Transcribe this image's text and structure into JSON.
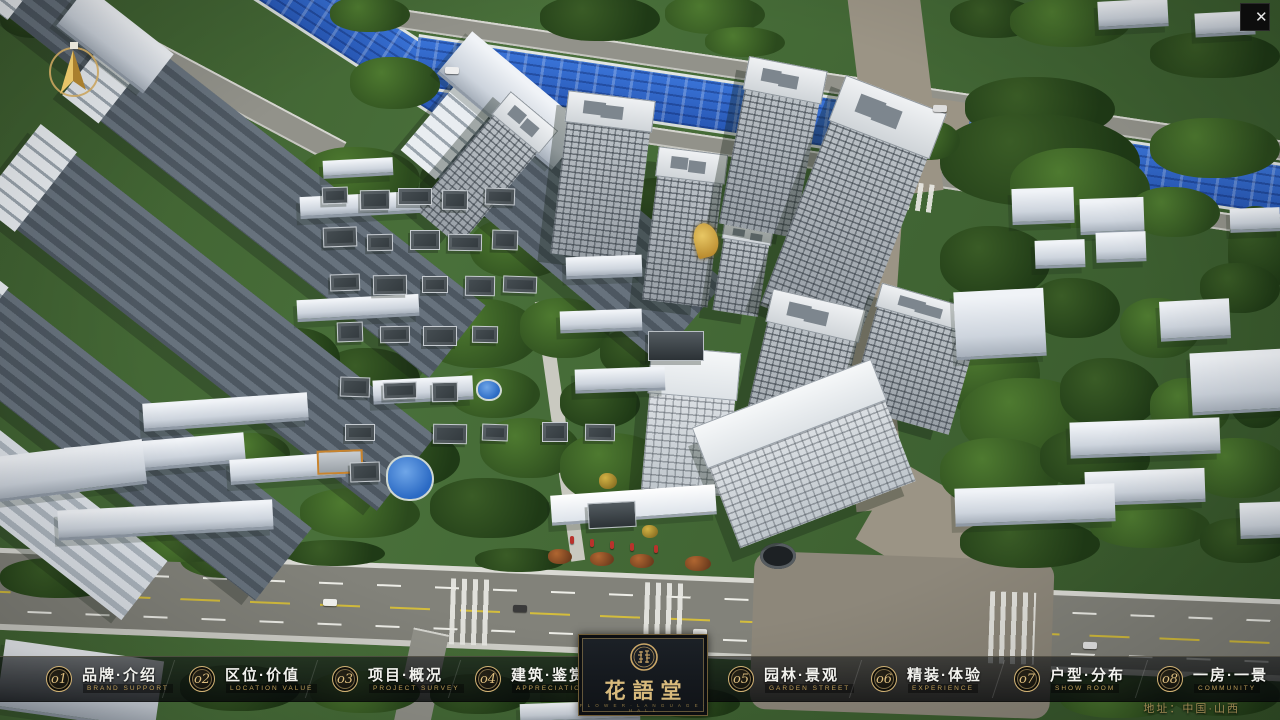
{
  "window": {
    "close_glyph": "✕"
  },
  "nav": {
    "items": [
      {
        "num": "o1",
        "zh": "品牌·介绍",
        "en": "BRAND SUPPORT"
      },
      {
        "num": "o2",
        "zh": "区位·价值",
        "en": "LOCATION VALUE"
      },
      {
        "num": "o3",
        "zh": "项目·概况",
        "en": "PROJECT SURVEY"
      },
      {
        "num": "o4",
        "zh": "建筑·鉴赏",
        "en": "APPRECIATION"
      },
      {
        "num": "o5",
        "zh": "园林·景观",
        "en": "GARDEN STREET"
      },
      {
        "num": "o6",
        "zh": "精装·体验",
        "en": "EXPERIENCE"
      },
      {
        "num": "o7",
        "zh": "户型·分布",
        "en": "SHOW ROOM"
      },
      {
        "num": "o8",
        "zh": "一房·一景",
        "en": "COMMUNITY"
      }
    ]
  },
  "logo": {
    "zh": "花語堂",
    "caption": "F L O W E R · L A N G U A G E · H A L L"
  },
  "footer": {
    "address": "地址：中国·山西"
  },
  "colors": {
    "gold": "#d2b375",
    "bar_bg": "rgba(10,13,15,0.7)",
    "river": "#2f66c8",
    "accent_red": "#b9322c"
  }
}
